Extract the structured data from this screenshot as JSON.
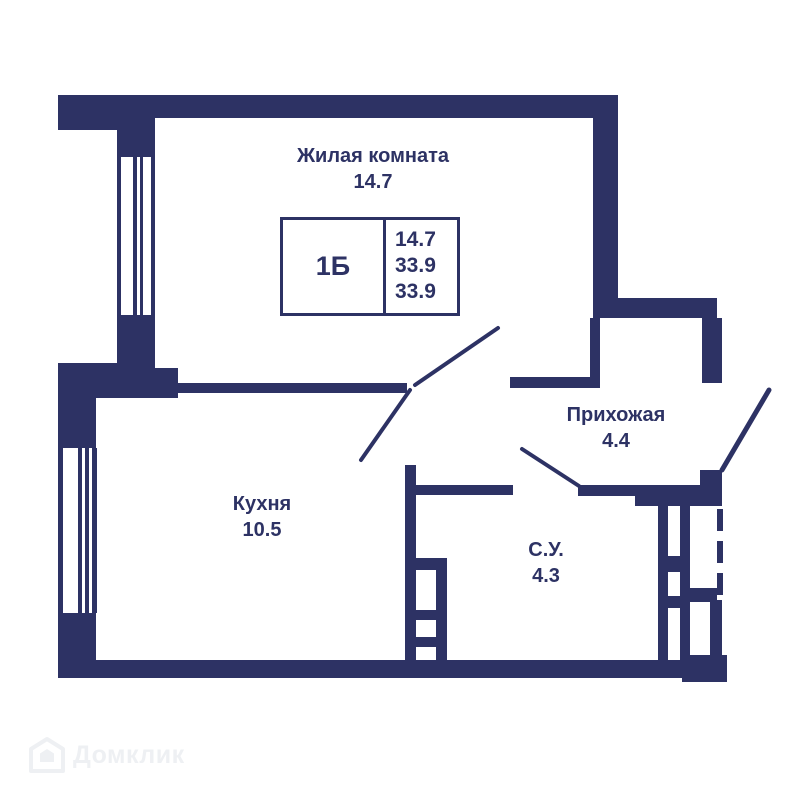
{
  "palette": {
    "wall": "#2d3264",
    "text": "#2d3264",
    "background": "#ffffff",
    "watermark": "#eef0f3"
  },
  "rooms": {
    "living": {
      "name": "Жилая комната",
      "area": "14.7"
    },
    "kitchen": {
      "name": "Кухня",
      "area": "10.5"
    },
    "hall": {
      "name": "Прихожая",
      "area": "4.4"
    },
    "bath": {
      "name": "С.У.",
      "area": "4.3"
    }
  },
  "info_box": {
    "unit": "1Б",
    "values": [
      "14.7",
      "33.9",
      "33.9"
    ]
  },
  "watermark": {
    "label": "Домклик"
  }
}
